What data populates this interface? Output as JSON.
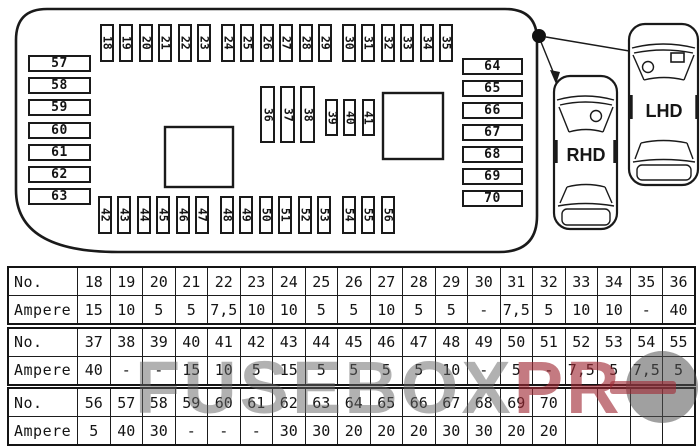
{
  "diagram": {
    "top_row_fuses": [
      "18",
      "19",
      "20",
      "21",
      "22",
      "23",
      "24",
      "25",
      "26",
      "27",
      "28",
      "29",
      "30",
      "31",
      "32",
      "33",
      "34",
      "35"
    ],
    "middle_tall_fuses": [
      "36",
      "37",
      "38"
    ],
    "middle_small_fuses": [
      "39",
      "40",
      "41"
    ],
    "bottom_row_fuses": [
      "42",
      "43",
      "44",
      "45",
      "46",
      "47",
      "48",
      "49",
      "50",
      "51",
      "52",
      "53",
      "54",
      "55",
      "56"
    ],
    "left_column_fuses": [
      "57",
      "58",
      "59",
      "60",
      "61",
      "62",
      "63"
    ],
    "right_column_fuses": [
      "64",
      "65",
      "66",
      "67",
      "68",
      "69",
      "70"
    ],
    "cars": {
      "left_label": "RHD",
      "right_label": "LHD"
    }
  },
  "table": {
    "row_header_no": "No.",
    "row_header_ampere": "Ampere",
    "sections": [
      {
        "numbers": [
          "18",
          "19",
          "20",
          "21",
          "22",
          "23",
          "24",
          "25",
          "26",
          "27",
          "28",
          "29",
          "30",
          "31",
          "32",
          "33",
          "34",
          "35",
          "36"
        ],
        "amperes": [
          "15",
          "10",
          "5",
          "5",
          "7,5",
          "10",
          "10",
          "5",
          "5",
          "10",
          "5",
          "5",
          "-",
          "7,5",
          "5",
          "10",
          "10",
          "-",
          "40"
        ]
      },
      {
        "numbers": [
          "37",
          "38",
          "39",
          "40",
          "41",
          "42",
          "43",
          "44",
          "45",
          "46",
          "47",
          "48",
          "49",
          "50",
          "51",
          "52",
          "53",
          "54",
          "55"
        ],
        "amperes": [
          "40",
          "-",
          "-",
          "15",
          "10",
          "5",
          "15",
          "5",
          "5",
          "5",
          "5",
          "10",
          "-",
          "5",
          "-",
          "7,5",
          "5",
          "7,5",
          "5"
        ]
      },
      {
        "numbers": [
          "56",
          "57",
          "58",
          "59",
          "60",
          "61",
          "62",
          "63",
          "64",
          "65",
          "66",
          "67",
          "68",
          "69",
          "70",
          "",
          "",
          "",
          ""
        ],
        "amperes": [
          "5",
          "40",
          "30",
          "-",
          "-",
          "-",
          "30",
          "30",
          "20",
          "20",
          "20",
          "30",
          "30",
          "20",
          "20",
          "",
          "",
          "",
          ""
        ]
      }
    ]
  },
  "watermark": {
    "gray_text": "FUSEBOX",
    "red_text": "PR",
    "gray_color": "#646464",
    "red_color": "#a02834"
  }
}
